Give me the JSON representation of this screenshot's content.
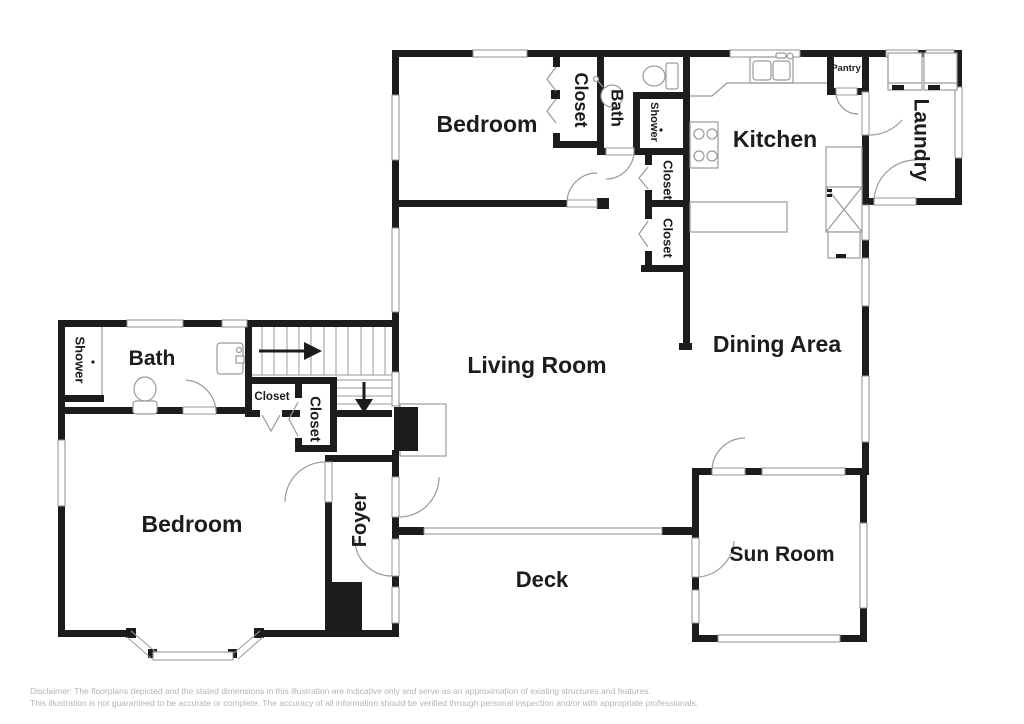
{
  "floorplan": {
    "rooms": {
      "bedroom_upper": "Bedroom",
      "closet_upper": "Closet",
      "bath_upper": "Bath",
      "shower_upper": "Shower",
      "closet_hall_1": "Closet",
      "closet_hall_2": "Closet",
      "kitchen": "Kitchen",
      "pantry": "Pantry",
      "laundry": "Laundry",
      "dining_area": "Dining Area",
      "living_room": "Living Room",
      "shower_main": "Shower",
      "bath_main": "Bath",
      "closet_stair": "Closet",
      "closet_bedroom": "Closet",
      "bedroom_main": "Bedroom",
      "foyer": "Foyer",
      "fireplace": "Fireplace",
      "deck": "Deck",
      "sun_room": "Sun Room"
    },
    "colors": {
      "wall": "#1c1c1c",
      "thin_line": "#9a9a9a",
      "label_text": "#1c1c1c",
      "fireplace_text": "#ffffff",
      "disclaimer_text": "#b4b4b4",
      "background": "#ffffff"
    },
    "disclaimer": {
      "line1": "Disclaimer: The floorplans depicted and the stated dimensions in this illustration are indicative only and serve as an approximation of existing structures and features.",
      "line2": "This illustration is not guaranteed to be accurate or complete. The accuracy of all information should be verified through personal inspection and/or with appropriate professionals."
    }
  }
}
